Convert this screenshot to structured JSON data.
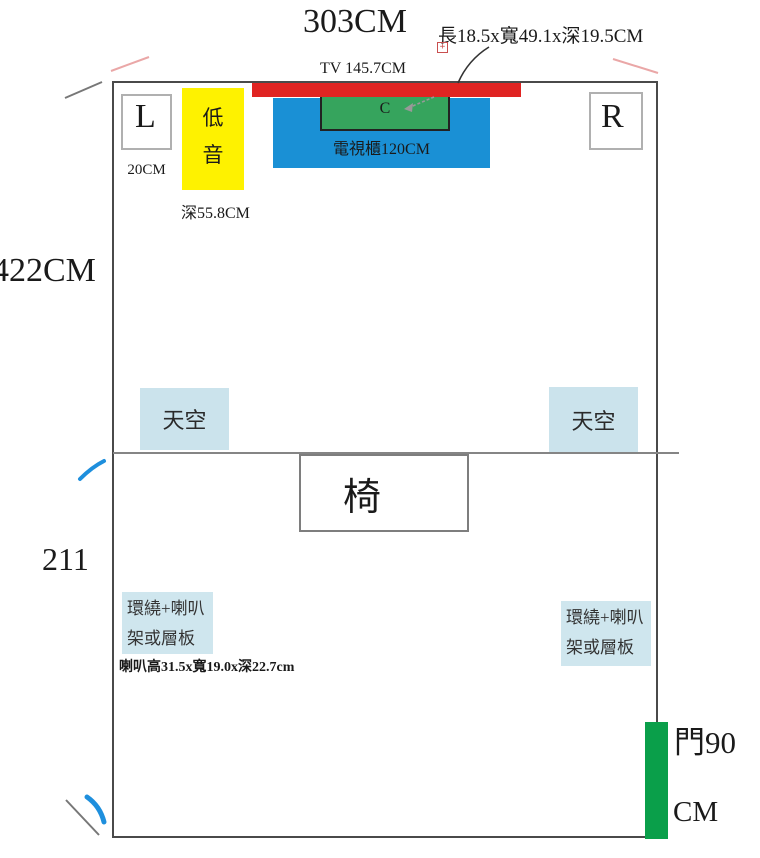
{
  "diagram_title": "home-theater-room-floor-plan",
  "top_annotations": {
    "room_width": "303CM",
    "tv_width": "TV 145.7CM",
    "center_speaker_dims": "長18.5x寬49.1x深19.5CM",
    "annotation_mark": "+"
  },
  "front_wall": {
    "left_speaker": "L",
    "left_speaker_offset": "20CM",
    "subwoofer": "低音",
    "subwoofer_depth": "深55.8CM",
    "tv_cabinet": "電視櫃120CM",
    "center_speaker": "C",
    "right_speaker": "R"
  },
  "side_annotations": {
    "upper_room_depth": "422CM",
    "lower_room_depth": "211"
  },
  "ceiling_speakers": {
    "left": "天空",
    "right": "天空"
  },
  "seating": {
    "chair": "椅"
  },
  "surround": {
    "left_line1": "環繞+喇叭",
    "left_line2": "架或層板",
    "right_line1": "環繞+喇叭",
    "right_line2": "架或層板",
    "speaker_dims": "喇叭高31.5x寬19.0x深22.7cm"
  },
  "door": {
    "label_line1": "門90",
    "label_line2": "CM"
  },
  "colors": {
    "tv_bar_red": "#e02422",
    "cabinet_blue": "#1a90d5",
    "center_speaker_green": "#36a45d",
    "subwoofer_yellow": "#fef200",
    "ceiling_light_blue": "#cbe3ec",
    "surround_light_blue": "#cfe6ee",
    "door_green": "#0a9f4a",
    "corner_mark_pink": "#eaa7a7",
    "mark_blue": "#1e8fdd",
    "line_gray": "#777777"
  }
}
